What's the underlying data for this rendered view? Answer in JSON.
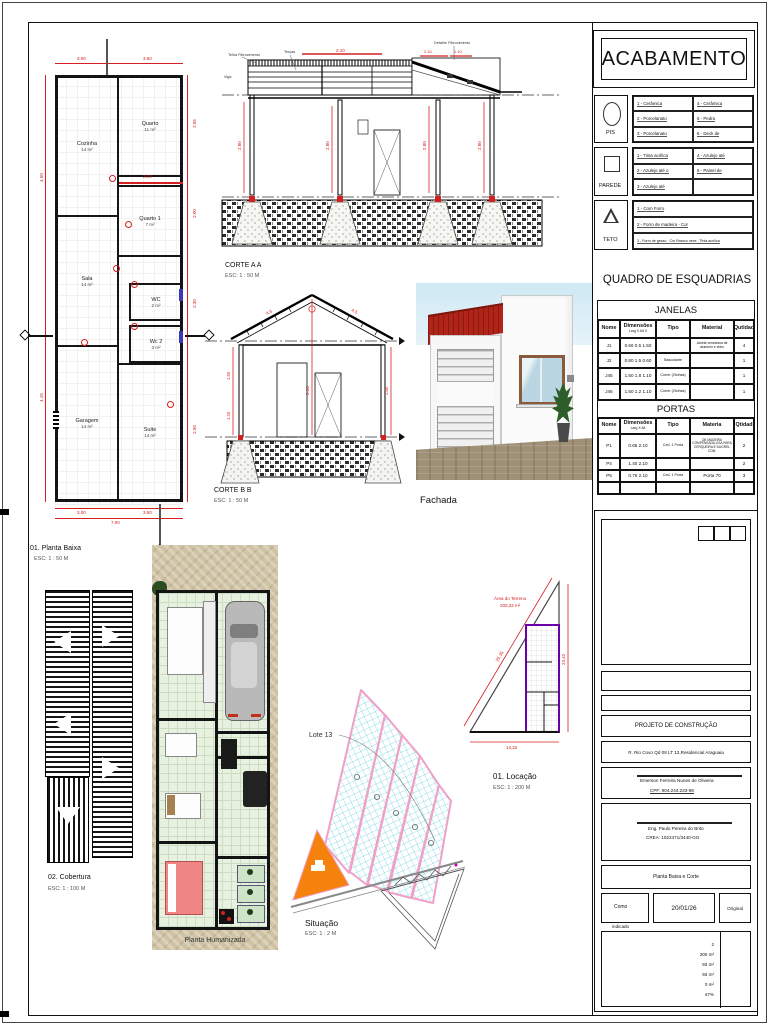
{
  "acabamento": {
    "title": "ACABAMENTO",
    "pis_label": "PIS",
    "parede_label": "PAREDE",
    "teto_label": "TETO",
    "pis_rows": [
      [
        "1 - Cerâmica",
        "4 - Cerâmica"
      ],
      [
        "2 - Porcelanato",
        "5 - Pedra"
      ],
      [
        "3 - Porcelanato",
        "6 - Deck de"
      ]
    ],
    "parede_rows": [
      [
        "1 - Tinta acrílica",
        "4 - Azulejo até"
      ],
      [
        "2 - Azulejo até o",
        "5 - Painel de"
      ],
      [
        "3 - Azulejo até",
        ""
      ]
    ],
    "teto_rows": [
      "1 - Com Forro",
      "2 - Forro de madeira - Cor",
      "3 - Forro de gesso - Cor Branco neve , Tinta acrílica"
    ]
  },
  "esquadrias": {
    "title": "QUADRO DE ESQUADRIAS",
    "janelas": {
      "title": "JANELAS",
      "headers": [
        "Nome",
        "Dimensões",
        "Tipo",
        "Material",
        "Qutidad"
      ],
      "dim_sub": "Larg X Alt X",
      "rows": [
        [
          "J1",
          "0.66  0.5  1.50",
          "",
          "Janela veneziana de alumínio e vidro",
          "4"
        ],
        [
          "J2",
          "0.80  1.5  0.60",
          "Basculante",
          "",
          "1"
        ],
        [
          "J45",
          "1.50  1.8  1.10",
          "Correr (2folhas)",
          "",
          "1"
        ],
        [
          "J46",
          "1.50  1.2  1.10",
          "Correr (2folhas)",
          "",
          "1"
        ]
      ]
    },
    "portas": {
      "title": "PORTAS",
      "headers": [
        "Nome",
        "Dimensões",
        "Tipo",
        "Materia",
        "Qtidad"
      ],
      "dim_sub": "Larg X Alt",
      "rows": [
        [
          "P1",
          "0.66  2.10",
          "Ced. 1 Porta",
          "DE MADEIRA COMPENSADA LISA PARA CERQUEIRA E DUGREL COM.",
          "2"
        ],
        [
          "P4",
          "1.40  2.10",
          "",
          "",
          "2"
        ],
        [
          "P5",
          "0.76  2.10",
          "Ced. 1 Porta",
          "Porta 70",
          "3"
        ]
      ]
    }
  },
  "titleblock": {
    "project": "PROJETO DE CONSTRUÇÃO",
    "address": "R. Rio Covo  Qd 08 LT 13,Residencial Araguaia",
    "owner": "Emerson Ferreira Nunes de Oliveira",
    "owner_cpf": "CPF: 904.244.233-86",
    "engineer": "Eng. Paulo Pereira do Brito",
    "engineer_crea": "CREA: 1022471/3440-GO",
    "sheet_name": "Planta Baixa e Corte",
    "scale_note1": "Como",
    "scale_note2": "indicado",
    "date": "20/01/26",
    "copy": "Original",
    "areas": [
      "2",
      "200 m²",
      "93 m²",
      "93 m²",
      "0 m²",
      "47%"
    ]
  },
  "planta": {
    "label": "01. Planta Baixa",
    "scale": "ESC: 1 : 50 M",
    "rooms": [
      {
        "name": "Cozinha",
        "area": "14 m²"
      },
      {
        "name": "Quarto",
        "area": "11 m²"
      },
      {
        "name": "Quarto 1",
        "area": "7 m²"
      },
      {
        "name": "Sala",
        "area": "14 m²"
      },
      {
        "name": "WC",
        "area": "2 m²"
      },
      {
        "name": "Wc 2",
        "area": "3 m²"
      },
      {
        "name": "Garagem",
        "area": "14 m²"
      },
      {
        "name": "Suite",
        "area": "14 m²"
      }
    ],
    "dims": {
      "top": [
        "3.00",
        "3.50"
      ],
      "bottom": [
        "3.00",
        "3.50"
      ],
      "bottom_total": "7.00",
      "left": [
        "4.50",
        "4.15"
      ],
      "right": [
        "2.95",
        "2.00",
        "2.30",
        "2.50"
      ],
      "inner": "2.00"
    }
  },
  "corte_a": {
    "label": "CORTE A A",
    "scale": "ESC: 1 : 50 M",
    "notes": {
      "telha": "Telha Fibrocimento",
      "tercas": "Terças",
      "viga": "Viga",
      "detalhe": "Detalhe Fibrocimento"
    },
    "dims": {
      "top": "2.10",
      "slope1": "2.10",
      "slope2": "1.10",
      "h1": "2.80",
      "h2": "2.80",
      "h3": "2.80",
      "h4": "2.80"
    }
  },
  "corte_b": {
    "label": "CORTE B B",
    "scale": "ESC: 1 : 50 M",
    "dims": {
      "slope_l": "4.5",
      "slope_r": "4.5",
      "center": "3.10",
      "wall_l1": "1.50",
      "wall_l2": "1.20",
      "wall_r": "2.80"
    }
  },
  "fachada": {
    "label": "Fachada"
  },
  "cobertura": {
    "label": "02. Cobertura",
    "scale": "ESC: 1 : 100 M"
  },
  "humanizada": {
    "label": "Planta Humanizada"
  },
  "situacao": {
    "label": "Situação",
    "scale": "ESC: 1 : 2 M",
    "lote": "Lote 13"
  },
  "locacao": {
    "label": "01. Locação",
    "scale": "ESC: 1 : 200 M",
    "area_line1": "Área do Terreno",
    "area_line2": "200,32 m²",
    "dims": {
      "hyp": "25,35",
      "right": "23,42",
      "bottom": "14,32"
    }
  }
}
